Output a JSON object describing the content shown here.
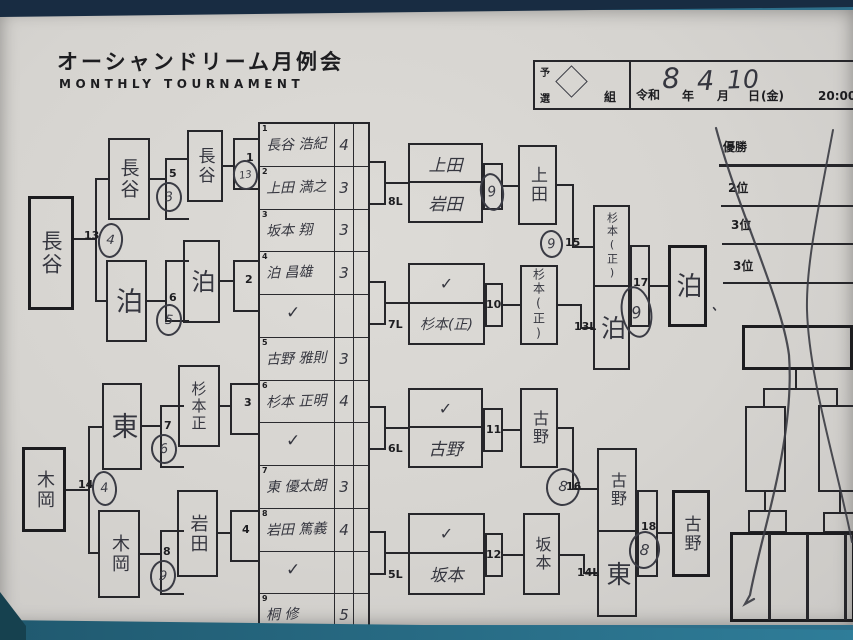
{
  "title": {
    "jp": "オーシャンドリーム月例会",
    "en": "MONTHLY  TOURNAMENT"
  },
  "header": {
    "pre_top": "予",
    "pre_bottom": "選",
    "group": "組",
    "era": "令和",
    "year_hand": "8",
    "year": "年",
    "month_hand": "4",
    "month": "月",
    "day_hand": "10",
    "day": "日",
    "weekday": "(金)",
    "time": "20:00〜"
  },
  "marks": {
    "check": "✓",
    "tick": "、"
  },
  "entries": [
    {
      "no": "1",
      "name": "長谷 浩紀",
      "score": "4"
    },
    {
      "no": "2",
      "name": "上田 満之",
      "score": "3"
    },
    {
      "no": "3",
      "name": "坂本 翔",
      "score": "3"
    },
    {
      "no": "4",
      "name": "泊 昌雄",
      "score": "3"
    },
    {
      "no": "5",
      "name": "古野 雅則",
      "score": "3"
    },
    {
      "no": "6",
      "name": "杉本 正明",
      "score": "4"
    },
    {
      "no": "7",
      "name": "東 優太朗",
      "score": "3"
    },
    {
      "no": "8",
      "name": "岩田 篤義",
      "score": "4"
    },
    {
      "no": "9",
      "name": "桐 修",
      "score": "5"
    }
  ],
  "left": {
    "final_top": "長谷",
    "final_bottom": "木岡",
    "r2_1": "長谷",
    "r2_2": "泊",
    "r2_3": "東",
    "r2_4": "木岡",
    "r1_1": "長谷",
    "r1_2": "泊",
    "r1_3": "杉本正",
    "r1_4": "岩田",
    "m1": "1",
    "m1c": "13",
    "m2": "2",
    "m3": "3",
    "m4": "4",
    "m5": "5",
    "m5c": "3",
    "m6": "6",
    "m6c": "5",
    "m7": "7",
    "m7c": "6",
    "m8": "8",
    "m8c": "9",
    "m13": "13",
    "m13c": "4",
    "m14": "14",
    "m14c": "4"
  },
  "right": {
    "p1_label": "8L",
    "p1_top": "上田",
    "p1_bottom": "岩田",
    "p1_circle": "9",
    "p1_winner": "上田",
    "p2_label": "7L",
    "p2_bottom": "杉本(正)",
    "p2_no": "10",
    "p2_winner": "杉本(正)",
    "p3_label": "6L",
    "p3_bottom": "古野",
    "p3_no": "11",
    "p3_winner": "古野",
    "p4_label": "5L",
    "p4_bottom": "坂本",
    "p4_no": "12",
    "p4_winner": "坂本",
    "m15": "15",
    "m15c": "9",
    "m16": "16",
    "m16c": "8",
    "sf1_label": "13L",
    "sf1_top": "杉本(正)",
    "sf1_bottom": "泊",
    "sf1_no": "17",
    "sf1_circle": "9",
    "sf1_winner": "泊",
    "sf2_label": "14L",
    "sf2_top": "古野",
    "sf2_bottom": "東",
    "sf2_no": "18",
    "sf2_circle": "8",
    "sf2_winner": "古野"
  },
  "results": {
    "champion": "優勝",
    "second": "2位",
    "third_a": "3位",
    "third_b": "3位"
  }
}
